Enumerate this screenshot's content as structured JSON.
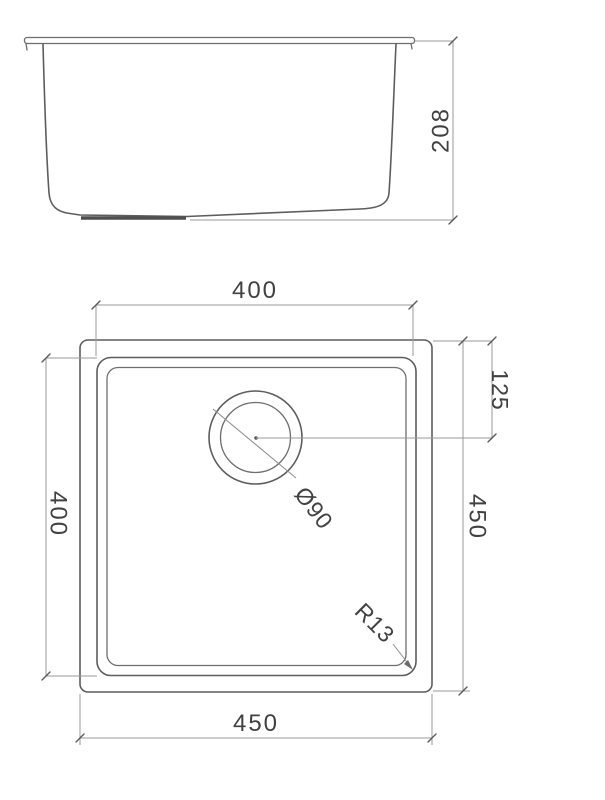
{
  "drawing": {
    "type": "sink-technical-drawing",
    "line_color": "#5d5d5d",
    "dimension_line_color": "#9a9a9a",
    "text_color": "#414141",
    "background_color": "#ffffff",
    "side_view": {
      "height": "208"
    },
    "plan_view": {
      "bowl_width": "400",
      "bowl_height": "400",
      "outer_height": "450",
      "drain_offset": "125",
      "outer_width": "450",
      "drain_diameter": "Ø90",
      "corner_radius": "R13"
    }
  }
}
